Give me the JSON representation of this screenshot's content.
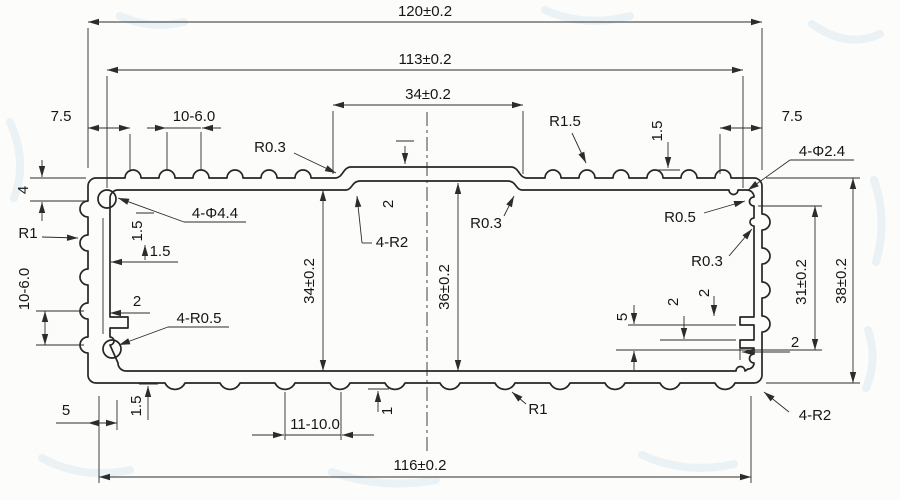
{
  "drawing": {
    "type": "extrusion-profile-cross-section",
    "colors": {
      "ink": "#262626",
      "paper": "#fcfcfa",
      "watermark": "#b9d6e8"
    },
    "labels": {
      "top_overall": "120±0.2",
      "top_inner": "113±0.2",
      "top_center": "34±0.2",
      "top_left_offset": "7.5",
      "top_right_offset": "7.5",
      "top_fin_pitch": "10-6.0",
      "top_fin_height": "1.5",
      "fin_radius": "R1.5",
      "ramp_radius": "R0.3",
      "right_screw_holes": "4-Φ2.4",
      "left_corner_height": "4",
      "left_radius": "R1",
      "left_fin_pitch": "10-6.0",
      "left_wall_thk_v": "1.5",
      "left_wall_thk_h": "1.5",
      "left_screw_holes": "4-Φ4.4",
      "left_rib": "2",
      "left_slot_radius": "4-R0.5",
      "left_bottom_offset": "5",
      "left_floor_thk": "1.5",
      "center_step": "2",
      "center_recess_radius": "4-R2",
      "center_pocket_radius": "R0.3",
      "cavity_height_left": "34±0.2",
      "cavity_height_mid": "36±0.2",
      "right_groove_radius": "R0.5",
      "right_boss_radius": "R0.3",
      "right_slot_offset": "5",
      "right_rib_a": "2",
      "right_rib_b": "2",
      "right_rib_depth": "2",
      "right_inner_height": "31±0.2",
      "right_overall_height": "38±0.2",
      "bottom_radius": "R1",
      "bottom_corner_radius": "4-R2",
      "bottom_fin_pitch": "11-10.0",
      "bottom_fin_depth": "1",
      "bottom_width": "116±0.2"
    }
  }
}
